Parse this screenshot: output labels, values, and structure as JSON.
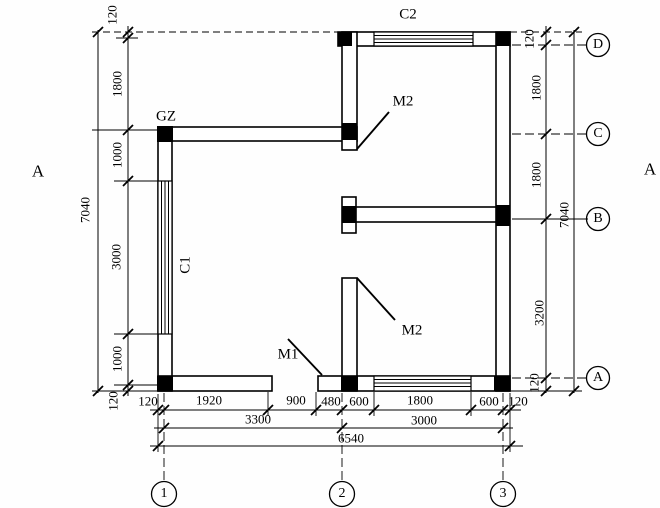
{
  "drawing": {
    "component_labels": {
      "gz": "GZ",
      "c1": "C1",
      "c2": "C2",
      "m1": "M1",
      "m2_upper": "M2",
      "m2_lower": "M2"
    },
    "section_marks": {
      "left": "A",
      "right": "A"
    },
    "axes": {
      "letters": [
        "D",
        "C",
        "B",
        "A"
      ],
      "numbers": [
        "1",
        "2",
        "3"
      ]
    },
    "dims": {
      "left": [
        "120",
        "1800",
        "1000",
        "3000",
        "1000",
        "120"
      ],
      "left_total": "7040",
      "right": [
        "120",
        "1800",
        "1800",
        "3200",
        "120"
      ],
      "right_total": "7040",
      "bottom_row1": [
        "120",
        "1920",
        "900",
        "480",
        "600",
        "1800",
        "600",
        "120"
      ],
      "bottom_row2": [
        "3300",
        "3000"
      ],
      "bottom_total": "6540"
    }
  }
}
